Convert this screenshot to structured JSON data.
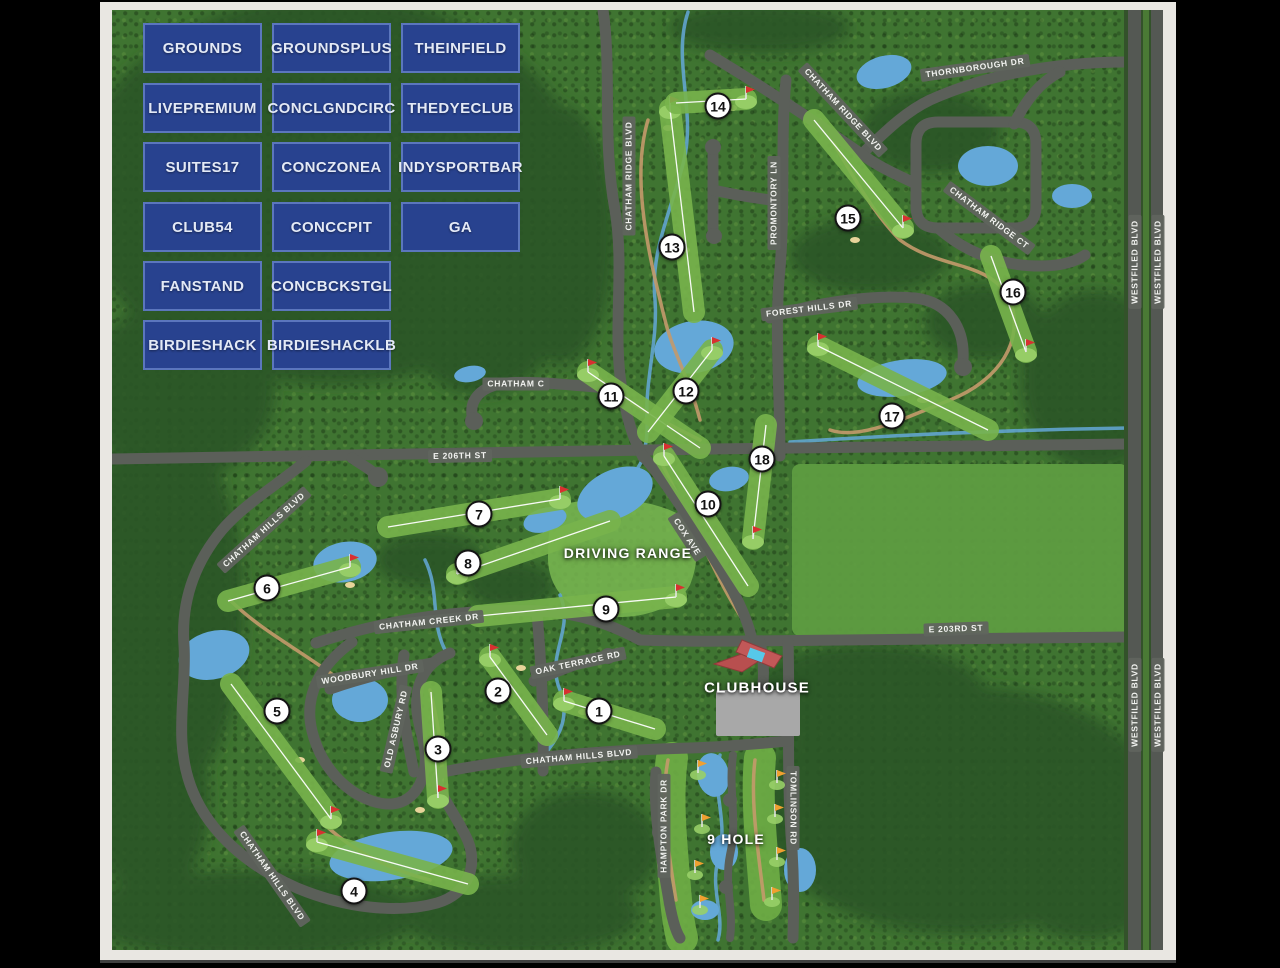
{
  "page": {
    "background": "#000000",
    "frame_color": "#e9e7e2"
  },
  "venue_buttons": {
    "rows": [
      [
        "GROUNDS",
        "GROUNDSPLUS",
        "THEINFIELD"
      ],
      [
        "LIVEPREMIUM",
        "CONCLGNDCIRC",
        "THEDYECLUB"
      ],
      [
        "SUITES17",
        "CONCZONEA",
        "INDYSPORTBAR"
      ],
      [
        "CLUB54",
        "CONCCPIT",
        "GA"
      ],
      [
        "FANSTAND",
        "CONCBCKSTGL"
      ],
      [
        "BIRDIESHACK",
        "BIRDIESHACKLB"
      ]
    ],
    "bg_color": "#28428f",
    "border_color": "#5b76bd",
    "text_color": "#e3e9f6"
  },
  "map": {
    "area_labels": [
      {
        "name": "driving-range-label",
        "text": "DRIVING RANGE",
        "x": 628,
        "y": 553,
        "size": 14
      },
      {
        "name": "nine-hole-label",
        "text": "9 HOLE",
        "x": 736,
        "y": 839,
        "size": 14
      },
      {
        "name": "clubhouse-label",
        "text": "CLUBHOUSE",
        "x": 757,
        "y": 688,
        "size": 15
      }
    ],
    "road_labels": [
      {
        "text": "THORNBOROUGH DR",
        "x": 975,
        "y": 68,
        "rot": -8
      },
      {
        "text": "CHATHAM RIDGE BLVD",
        "x": 629,
        "y": 176,
        "rot": -90
      },
      {
        "text": "CHATHAM RIDGE BLVD",
        "x": 843,
        "y": 110,
        "rot": 47
      },
      {
        "text": "CHATHAM RIDGE CT",
        "x": 989,
        "y": 218,
        "rot": 37
      },
      {
        "text": "WESTFILED BLVD",
        "x": 1135,
        "y": 262,
        "rot": -90
      },
      {
        "text": "WESTFILED BLVD",
        "x": 1158,
        "y": 262,
        "rot": -90
      },
      {
        "text": "WESTFILED BLVD",
        "x": 1135,
        "y": 705,
        "rot": -90
      },
      {
        "text": "WESTFILED BLVD",
        "x": 1158,
        "y": 705,
        "rot": -90
      },
      {
        "text": "PROMONTORY LN",
        "x": 774,
        "y": 203,
        "rot": -90
      },
      {
        "text": "FOREST HILLS DR",
        "x": 809,
        "y": 309,
        "rot": -7
      },
      {
        "text": "E 206TH ST",
        "x": 460,
        "y": 456,
        "rot": -1
      },
      {
        "text": "CHATHAM C",
        "x": 516,
        "y": 384,
        "rot": 0
      },
      {
        "text": "CHATHAM HILLS BLVD",
        "x": 264,
        "y": 530,
        "rot": -42
      },
      {
        "text": "COX AVE",
        "x": 687,
        "y": 537,
        "rot": 57
      },
      {
        "text": "CHATHAM CREEK DR",
        "x": 429,
        "y": 622,
        "rot": -6
      },
      {
        "text": "WOODBURY HILL DR",
        "x": 370,
        "y": 674,
        "rot": -9
      },
      {
        "text": "OLD ASBURY RD",
        "x": 396,
        "y": 729,
        "rot": -77
      },
      {
        "text": "OAK TERRACE RD",
        "x": 578,
        "y": 663,
        "rot": -12
      },
      {
        "text": "E 203RD ST",
        "x": 956,
        "y": 629,
        "rot": -2
      },
      {
        "text": "CHATHAM HILLS BLVD",
        "x": 579,
        "y": 757,
        "rot": -5
      },
      {
        "text": "CHATHAM HILLS BLVD",
        "x": 272,
        "y": 876,
        "rot": 55
      },
      {
        "text": "HAMPTON PARK DR",
        "x": 664,
        "y": 826,
        "rot": -90
      },
      {
        "text": "TOMLINSON RD",
        "x": 793,
        "y": 808,
        "rot": 90
      }
    ],
    "holes": [
      {
        "n": "1",
        "marker": [
          599,
          711
        ],
        "tee": [
          655,
          729
        ],
        "green": [
          564,
          701
        ]
      },
      {
        "n": "2",
        "marker": [
          498,
          691
        ],
        "tee": [
          547,
          735
        ],
        "green": [
          490,
          657
        ]
      },
      {
        "n": "3",
        "marker": [
          438,
          749
        ],
        "tee": [
          431,
          692
        ],
        "green": [
          438,
          798
        ]
      },
      {
        "n": "4",
        "marker": [
          354,
          891
        ],
        "tee": [
          468,
          884
        ],
        "green": [
          317,
          842
        ]
      },
      {
        "n": "5",
        "marker": [
          277,
          711
        ],
        "tee": [
          231,
          684
        ],
        "green": [
          331,
          819
        ]
      },
      {
        "n": "6",
        "marker": [
          267,
          588
        ],
        "tee": [
          228,
          601
        ],
        "green": [
          350,
          567
        ]
      },
      {
        "n": "7",
        "marker": [
          479,
          514
        ],
        "tee": [
          388,
          527
        ],
        "green": [
          560,
          499
        ]
      },
      {
        "n": "8",
        "marker": [
          468,
          563
        ],
        "tee": [
          610,
          521
        ],
        "green": [
          457,
          574
        ]
      },
      {
        "n": "9",
        "marker": [
          606,
          609
        ],
        "tee": [
          478,
          616
        ],
        "green": [
          676,
          597
        ]
      },
      {
        "n": "10",
        "marker": [
          708,
          504
        ],
        "tee": [
          748,
          586
        ],
        "green": [
          664,
          456
        ]
      },
      {
        "n": "11",
        "marker": [
          611,
          396
        ],
        "tee": [
          700,
          448
        ],
        "green": [
          588,
          372
        ]
      },
      {
        "n": "12",
        "marker": [
          686,
          391
        ],
        "tee": [
          648,
          432
        ],
        "green": [
          712,
          350
        ]
      },
      {
        "n": "13",
        "marker": [
          672,
          247
        ],
        "tee": [
          694,
          312
        ],
        "green": [
          670,
          109
        ]
      },
      {
        "n": "14",
        "marker": [
          718,
          106
        ],
        "tee": [
          676,
          103
        ],
        "green": [
          746,
          99
        ]
      },
      {
        "n": "15",
        "marker": [
          848,
          218
        ],
        "tee": [
          814,
          120
        ],
        "green": [
          903,
          228
        ]
      },
      {
        "n": "16",
        "marker": [
          1013,
          292
        ],
        "tee": [
          991,
          256
        ],
        "green": [
          1026,
          352
        ]
      },
      {
        "n": "17",
        "marker": [
          892,
          416
        ],
        "tee": [
          988,
          430
        ],
        "green": [
          818,
          346
        ]
      },
      {
        "n": "18",
        "marker": [
          762,
          459
        ],
        "tee": [
          766,
          425
        ],
        "green": [
          753,
          539
        ]
      }
    ],
    "nine_hole_flags": [
      [
        698,
        773
      ],
      [
        702,
        827
      ],
      [
        695,
        873
      ],
      [
        700,
        908
      ],
      [
        777,
        783
      ],
      [
        775,
        817
      ],
      [
        777,
        860
      ],
      [
        772,
        900
      ]
    ],
    "colors": {
      "flag_red": "#d83030",
      "flag_orange": "#f0a030",
      "water": "#64a8d8",
      "road": "#5b5f59",
      "fairway": "#78b44c",
      "green": "#98cf68",
      "forest": "#2c5526",
      "base_green": "#3f7431"
    }
  }
}
